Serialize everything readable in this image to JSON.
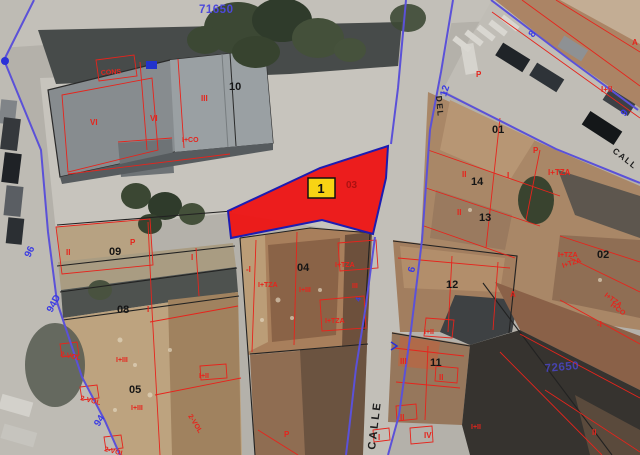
{
  "map": {
    "type": "cadastral-aerial",
    "colors": {
      "parcel_fill": "#ef1010",
      "parcel_border": "#1c1cb2",
      "badge_bg": "#f8d414",
      "cadastre_red": "#e6241c",
      "cadastre_blue": "#5b51d8",
      "label_blue": "#4d49da",
      "label_black": "#151515"
    },
    "highlight": {
      "badge_label": "1",
      "parcel_label": "03",
      "polygon": "388,146 320,168 228,211 231,238 322,220 373,234 386,178"
    },
    "labels": [
      {
        "n": "block-number-top",
        "t": "71650",
        "x": 199,
        "y": 13,
        "r": 0,
        "c": "blue-big"
      },
      {
        "n": "block-number-bottom-right",
        "t": "72650",
        "x": 545,
        "y": 372,
        "r": -5,
        "c": "blue-big",
        "o": 0.75
      },
      {
        "n": "house-number",
        "t": "8",
        "x": 533,
        "y": 38,
        "r": -52,
        "c": "blue-num"
      },
      {
        "n": "house-number",
        "t": "12",
        "x": 446,
        "y": 97,
        "r": -72,
        "c": "blue-num"
      },
      {
        "n": "house-number",
        "t": "9",
        "x": 625,
        "y": 117,
        "r": -50,
        "c": "blue-num"
      },
      {
        "n": "house-number",
        "t": "6",
        "x": 414,
        "y": 273,
        "r": -75,
        "c": "blue-num"
      },
      {
        "n": "house-number",
        "t": "96",
        "x": 30,
        "y": 258,
        "r": -65,
        "c": "blue-num"
      },
      {
        "n": "house-number",
        "t": "94D",
        "x": 52,
        "y": 313,
        "r": -62,
        "c": "blue-num"
      },
      {
        "n": "house-number",
        "t": "94",
        "x": 99,
        "y": 427,
        "r": -58,
        "c": "blue-num"
      },
      {
        "n": "house-number",
        "t": "4",
        "x": 360,
        "y": 302,
        "r": -75,
        "c": "blue-num-s"
      },
      {
        "n": "street-name",
        "t": "CALLE",
        "x": 375,
        "y": 450,
        "r": -83,
        "c": "street"
      },
      {
        "n": "street-name",
        "t": "CALL",
        "x": 612,
        "y": 152,
        "r": 38,
        "c": "street-s"
      },
      {
        "n": "street-name",
        "t": "DEL",
        "x": 436,
        "y": 96,
        "r": 85,
        "c": "street-s"
      },
      {
        "n": "parcel-number-10",
        "t": "10",
        "x": 229,
        "y": 90,
        "c": "pnum"
      },
      {
        "n": "parcel-number-01",
        "t": "01",
        "x": 492,
        "y": 133,
        "c": "pnum"
      },
      {
        "n": "parcel-number-14",
        "t": "14",
        "x": 471,
        "y": 185,
        "c": "pnum"
      },
      {
        "n": "parcel-number-13",
        "t": "13",
        "x": 479,
        "y": 221,
        "c": "pnum"
      },
      {
        "n": "parcel-number-02",
        "t": "02",
        "x": 597,
        "y": 258,
        "c": "pnum"
      },
      {
        "n": "parcel-number-12",
        "t": "12",
        "x": 446,
        "y": 288,
        "c": "pnum"
      },
      {
        "n": "parcel-number-04",
        "t": "04",
        "x": 297,
        "y": 271,
        "c": "pnum"
      },
      {
        "n": "parcel-number-09",
        "t": "09",
        "x": 109,
        "y": 255,
        "c": "pnum"
      },
      {
        "n": "parcel-number-08",
        "t": "08",
        "x": 117,
        "y": 313,
        "c": "pnum"
      },
      {
        "n": "parcel-number-05",
        "t": "05",
        "x": 129,
        "y": 393,
        "c": "pnum"
      },
      {
        "n": "parcel-number-11",
        "t": "11",
        "x": 430,
        "y": 366,
        "c": "pnum"
      },
      {
        "n": "parcel-number-03",
        "t": "03",
        "x": 346,
        "y": 188,
        "c": "pnum-red"
      },
      {
        "n": "floors-annotation",
        "t": "CONS",
        "x": 101,
        "y": 75,
        "r": -4,
        "c": "red-s"
      },
      {
        "n": "floors-annotation",
        "t": "VI",
        "x": 90,
        "y": 125,
        "c": "red"
      },
      {
        "n": "floors-annotation",
        "t": "VI",
        "x": 150,
        "y": 121,
        "c": "red"
      },
      {
        "n": "floors-annotation",
        "t": "III",
        "x": 201,
        "y": 101,
        "c": "red"
      },
      {
        "n": "floors-annotation",
        "t": "I+CO",
        "x": 182,
        "y": 142,
        "c": "red-s"
      },
      {
        "n": "floors-annotation",
        "t": "P",
        "x": 476,
        "y": 77,
        "c": "red"
      },
      {
        "n": "floors-annotation",
        "t": "I+II",
        "x": 601,
        "y": 92,
        "c": "red"
      },
      {
        "n": "floors-annotation",
        "t": "A",
        "x": 632,
        "y": 45,
        "c": "red"
      },
      {
        "n": "floors-annotation",
        "t": "II",
        "x": 462,
        "y": 177,
        "c": "red"
      },
      {
        "n": "floors-annotation",
        "t": "I",
        "x": 507,
        "y": 178,
        "c": "red"
      },
      {
        "n": "floors-annotation",
        "t": "I+TZA",
        "x": 548,
        "y": 175,
        "c": "red"
      },
      {
        "n": "floors-annotation",
        "t": "P",
        "x": 533,
        "y": 153,
        "c": "red"
      },
      {
        "n": "floors-annotation",
        "t": "II",
        "x": 457,
        "y": 215,
        "c": "red"
      },
      {
        "n": "floors-annotation",
        "t": "I+TZA",
        "x": 558,
        "y": 257,
        "c": "red-s"
      },
      {
        "n": "floors-annotation",
        "t": "I+TZA",
        "x": 563,
        "y": 268,
        "r": -18,
        "c": "red-s"
      },
      {
        "n": "floors-annotation",
        "t": "I+TZA",
        "x": 604,
        "y": 296,
        "r": 36,
        "c": "red-s"
      },
      {
        "n": "floors-annotation",
        "t": "I+CO",
        "x": 610,
        "y": 306,
        "r": 36,
        "c": "red-s"
      },
      {
        "n": "floors-annotation",
        "t": "-I",
        "x": 597,
        "y": 327,
        "c": "red"
      },
      {
        "n": "floors-annotation",
        "t": "-I",
        "x": 246,
        "y": 272,
        "c": "red"
      },
      {
        "n": "floors-annotation",
        "t": "I+TZA",
        "x": 258,
        "y": 287,
        "c": "red-s"
      },
      {
        "n": "floors-annotation",
        "t": "I+III",
        "x": 299,
        "y": 292,
        "c": "red-s"
      },
      {
        "n": "floors-annotation",
        "t": "I+TZA",
        "x": 335,
        "y": 267,
        "c": "red-s"
      },
      {
        "n": "floors-annotation",
        "t": "III",
        "x": 352,
        "y": 288,
        "c": "red-s"
      },
      {
        "n": "floors-annotation",
        "t": "I+TZA",
        "x": 325,
        "y": 323,
        "c": "red-s"
      },
      {
        "n": "floors-annotation",
        "t": "II",
        "x": 66,
        "y": 255,
        "c": "red"
      },
      {
        "n": "floors-annotation",
        "t": "P",
        "x": 130,
        "y": 245,
        "c": "red"
      },
      {
        "n": "floors-annotation",
        "t": "I",
        "x": 191,
        "y": 260,
        "c": "red"
      },
      {
        "n": "floors-annotation",
        "t": "I",
        "x": 147,
        "y": 312,
        "c": "red"
      },
      {
        "n": "floors-annotation",
        "t": "2-VOL",
        "x": 60,
        "y": 356,
        "r": 12,
        "c": "red-s"
      },
      {
        "n": "floors-annotation",
        "t": "I+III",
        "x": 116,
        "y": 362,
        "c": "red-s"
      },
      {
        "n": "floors-annotation",
        "t": "2-VOL",
        "x": 80,
        "y": 400,
        "r": 14,
        "c": "red-s"
      },
      {
        "n": "floors-annotation",
        "t": "I+III",
        "x": 131,
        "y": 410,
        "c": "red-s"
      },
      {
        "n": "floors-annotation",
        "t": "I+II",
        "x": 199,
        "y": 378,
        "c": "red-s"
      },
      {
        "n": "floors-annotation",
        "t": "2-VOL",
        "x": 104,
        "y": 451,
        "r": 14,
        "c": "red-s"
      },
      {
        "n": "floors-annotation",
        "t": "2-VOL",
        "x": 188,
        "y": 416,
        "r": 58,
        "c": "red-s"
      },
      {
        "n": "floors-annotation",
        "t": "I+II",
        "x": 424,
        "y": 334,
        "c": "red-s"
      },
      {
        "n": "floors-annotation",
        "t": "III",
        "x": 400,
        "y": 364,
        "c": "red"
      },
      {
        "n": "floors-annotation",
        "t": "II",
        "x": 439,
        "y": 380,
        "c": "red"
      },
      {
        "n": "floors-annotation",
        "t": "II",
        "x": 400,
        "y": 420,
        "c": "red"
      },
      {
        "n": "floors-annotation",
        "t": "IV",
        "x": 424,
        "y": 438,
        "c": "red"
      },
      {
        "n": "floors-annotation",
        "t": "I",
        "x": 378,
        "y": 440,
        "c": "red"
      },
      {
        "n": "floors-annotation",
        "t": "A",
        "x": 510,
        "y": 297,
        "c": "red"
      },
      {
        "n": "floors-annotation",
        "t": "I+II",
        "x": 471,
        "y": 429,
        "c": "red-s"
      },
      {
        "n": "floors-annotation",
        "t": "II",
        "x": 592,
        "y": 435,
        "c": "red"
      },
      {
        "n": "floors-annotation",
        "t": "P",
        "x": 284,
        "y": 437,
        "c": "red"
      }
    ]
  }
}
